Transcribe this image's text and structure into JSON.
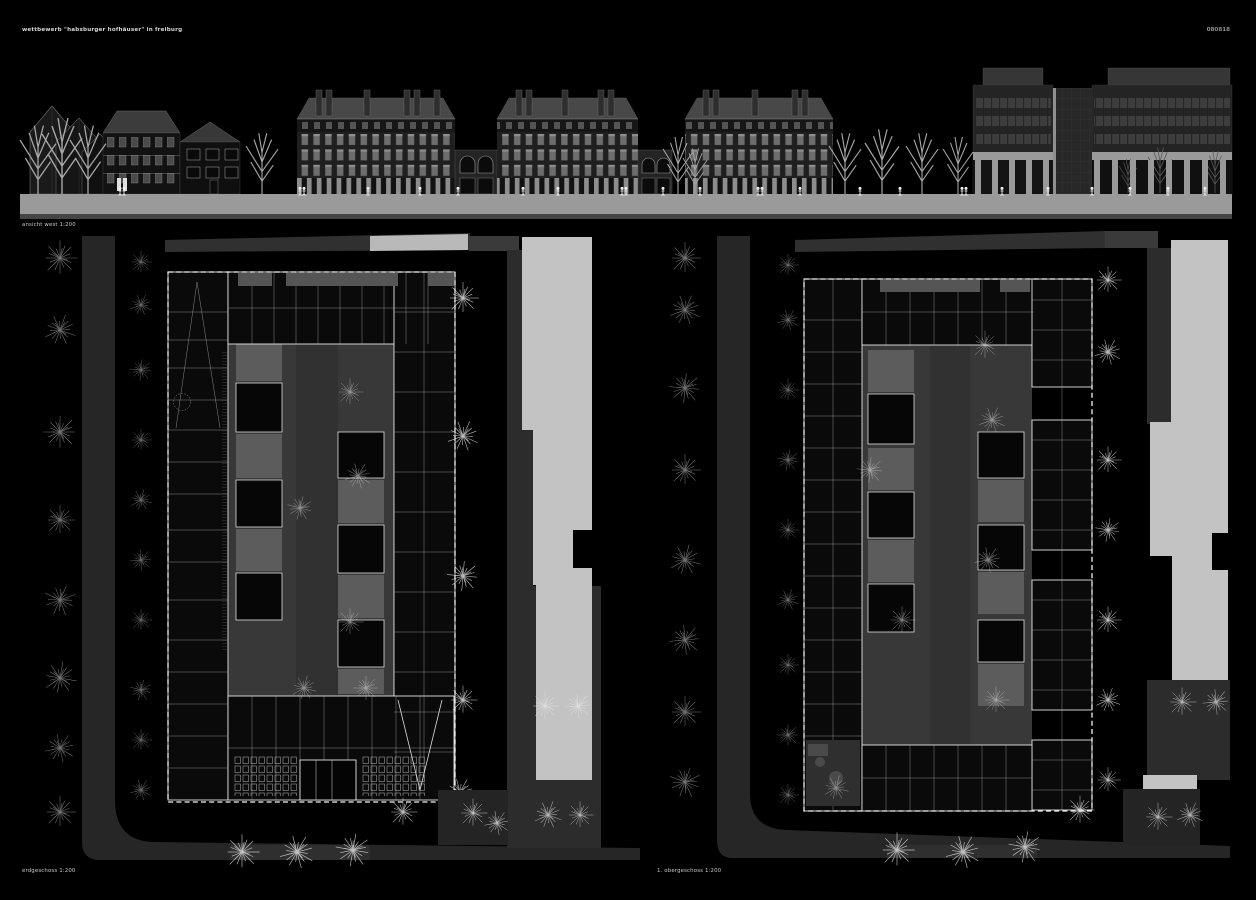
{
  "board": {
    "title": "wettbewerb \"habsburger hofhäuser\" in freiburg",
    "code": "080818",
    "captions": {
      "elevation": "ansicht west 1:200",
      "plan_left": "erdgeschoss 1:200",
      "plan_right": "1. obergeschoss 1:200"
    }
  },
  "palette": {
    "background": "#000000",
    "ground_band": "#9a9a9a",
    "street": "#272727",
    "courtyard": "#383838",
    "garden_patch": "#5c5c5c",
    "sidewalk": "#c3c3c3",
    "plan_walls": "#ffffff",
    "facade_dark": "#1f1f1f",
    "window_light": "#6b6b6b"
  }
}
